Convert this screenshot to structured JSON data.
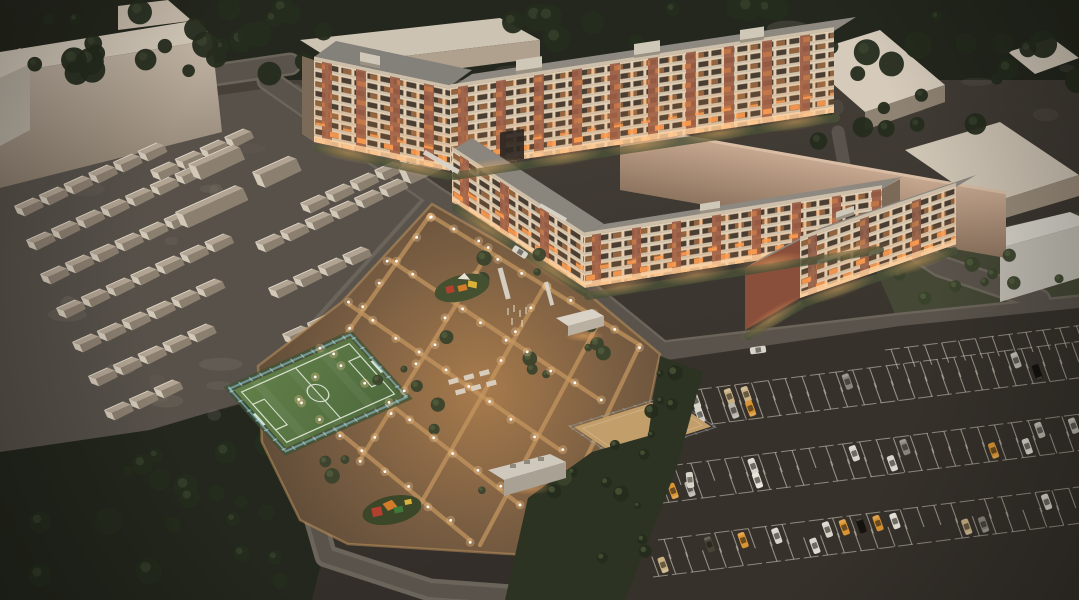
{
  "meta": {
    "description": "Aerial dusk 3D architectural rendering of a residential complex: long apartment blocks with brick piers and warmly lit windows, a glowing central courtyard with playgrounds and lamps, a fenced soccer field, a sand court, rows of garages, surrounding warehouses and dark trees, and a large half-full parking lot.",
    "type": "architectural-visualization",
    "time_of_day": "evening"
  },
  "palette": {
    "ground": "#3e3831",
    "ground_light": "#857c6f",
    "garage_ground": "#57514a",
    "forest": "#20251b",
    "tree_dark": "#252c1e",
    "tree_light": "#49563a",
    "shrub": "#3a422c",
    "shrub_light": "#5e6c46",
    "road": "#59534b",
    "road_edge": "#6b645a",
    "big_wall_light": "#c3b6a6",
    "big_wall_dark": "#8a7d6d",
    "context_roof": "#d3c9b9",
    "context_face": "#b2a493",
    "context_shadow": "#8b7f70",
    "blank_top": "#c6a78f",
    "blank_bottom": "#8e7560",
    "facade_light": "#e3cfb4",
    "brick": "#9a5c44",
    "roof": "#8d8880",
    "parapet": "#cdbfa9",
    "window_dark": "#4a3e33",
    "window_lit": "#ff9d50",
    "ground_floor_glow": "#ffd2a0",
    "field_green": "#5c7a46",
    "field_line": "#e2e9d9",
    "fence_blue": "#8ecfe4",
    "sand": "#c29e6b",
    "sand_line": "#dcc39a",
    "court_fence": "#9aa3a8",
    "courtyard_base": "#6e563e",
    "courtyard_warm": "#a87b4c",
    "path": "#c59760",
    "lamp": "#ffffff",
    "lamp_halo": "#ffcf96",
    "asphalt": "#36312b",
    "stall_line": "#d6cfc1",
    "pad_green": "#44502f",
    "play_red": "#b3402e",
    "play_orange": "#d07c2a",
    "play_yellow": "#d9b23a",
    "play_green": "#3f7a3a",
    "white_structure": "#d9d3c7",
    "car_colors": [
      "#d9d5cb",
      "#b9b5aa",
      "#16130f",
      "#d99433",
      "#c9b184",
      "#494337",
      "#8a867c",
      "#e8e4da"
    ]
  },
  "counts": {
    "garage_houses": 62,
    "garage_sheds": 5,
    "parked_cars": 34,
    "road_cars": 3,
    "street_lamps": 72,
    "courtyard_trees": 24,
    "hedge_shrubs": 16,
    "forest_trees": 88,
    "lawn_bushes": 10
  },
  "scene_elements": [
    "forest",
    "garage-rows",
    "big-warehouse",
    "context-warehouses",
    "apartment-block-long",
    "apartment-block-l-shaped",
    "apartment-block-small",
    "soccer-field",
    "sand-court",
    "courtyard",
    "playgrounds",
    "pavilion",
    "utility-building",
    "parking-lot",
    "roads"
  ]
}
